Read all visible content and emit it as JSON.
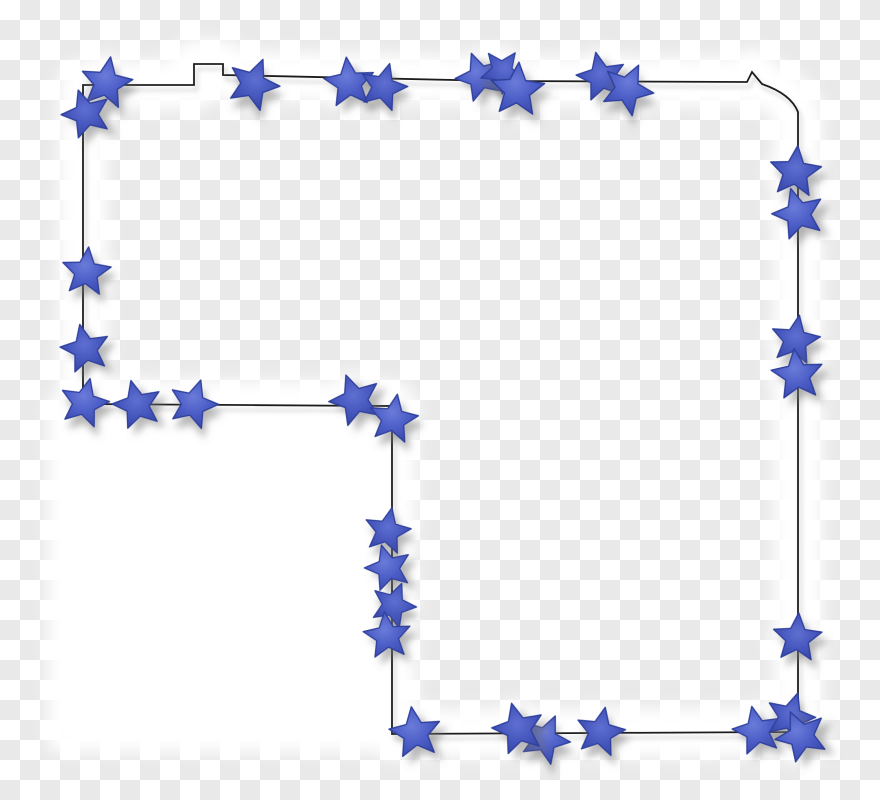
{
  "image": {
    "type": "clipart-star-border-frame",
    "description": "L-shaped black map-style outline decorated with blue cut-out stars on a transparency checkerboard, with soft white halo backing",
    "width": 880,
    "height": 800
  },
  "background": {
    "square_size": 20,
    "light": "#ffffff",
    "dark": "#e9e9e9"
  },
  "halo": {
    "color": "#ffffff",
    "outline_band_width": 48,
    "star_glow_radius": 28,
    "blur": 8,
    "bottom_left_rect": {
      "x": 48,
      "y": 396,
      "width": 344,
      "height": 356
    }
  },
  "outline": {
    "path_d": "M 83 85 L 194 85 L 194 64 L 223 64 L 223 75 L 500 81 L 747 82 L 752 72 L 762 84 Q 791 94 798 112 L 798 732 L 392 734 L 392 406 L 83 404 Z",
    "color": "#1f1f1f",
    "width": 1.8,
    "shadow": {
      "dx": 3,
      "dy": 5,
      "blur": 2.2,
      "color": "#8a8a8a",
      "opacity": 0.45
    }
  },
  "star_shape": {
    "path_d": "M 0 -26.5 L 7.6 -9.4 L 25.8 -8 L 12.2 4.2 L 16.4 21.8 L 0.4 12.2 L -15.4 21.4 L -11.6 3.8 L -25.2 -7.4 L -7.4 -9.6 Z"
  },
  "stars": {
    "fill_center": "#6b7bd9",
    "fill_mid": "#4c5ec7",
    "fill_edge": "#3b4aad",
    "fill_center_b": "#5f6fd0",
    "fill_mid_b": "#4556bd",
    "fill_edge_b": "#36459f",
    "stroke": "#2f3f9c",
    "shadow": {
      "dx": 6,
      "dy": 8,
      "blur": 4,
      "color": "#6f6f6f",
      "opacity": 0.5
    },
    "count": 33,
    "items": [
      {
        "cx": 106,
        "cy": 83,
        "rot": 10,
        "s": 1
      },
      {
        "cx": 86,
        "cy": 114,
        "rot": -18,
        "s": 0.95
      },
      {
        "cx": 86,
        "cy": 272,
        "rot": 6,
        "s": 0.95
      },
      {
        "cx": 85,
        "cy": 349,
        "rot": -12,
        "s": 0.95
      },
      {
        "cx": 84,
        "cy": 403,
        "rot": 14,
        "s": 0.95
      },
      {
        "cx": 253,
        "cy": 84,
        "rot": 22,
        "s": 1
      },
      {
        "cx": 349,
        "cy": 83,
        "rot": -6,
        "s": 0.98
      },
      {
        "cx": 383,
        "cy": 87,
        "rot": 16,
        "s": 0.92
      },
      {
        "cx": 480,
        "cy": 77,
        "rot": -20,
        "s": 0.95
      },
      {
        "cx": 502,
        "cy": 71,
        "rot": 36,
        "s": 0.85
      },
      {
        "cx": 517,
        "cy": 90,
        "rot": 4,
        "s": 1.05
      },
      {
        "cx": 601,
        "cy": 77,
        "rot": -12,
        "s": 0.95
      },
      {
        "cx": 627,
        "cy": 89,
        "rot": 26,
        "s": 1
      },
      {
        "cx": 795,
        "cy": 172,
        "rot": 6,
        "s": 1
      },
      {
        "cx": 798,
        "cy": 214,
        "rot": -16,
        "s": 1
      },
      {
        "cx": 795,
        "cy": 340,
        "rot": 10,
        "s": 0.95
      },
      {
        "cx": 797,
        "cy": 375,
        "rot": -6,
        "s": 1
      },
      {
        "cx": 797,
        "cy": 638,
        "rot": 4,
        "s": 0.95
      },
      {
        "cx": 757,
        "cy": 731,
        "rot": -12,
        "s": 0.95
      },
      {
        "cx": 790,
        "cy": 717,
        "rot": 18,
        "s": 0.95
      },
      {
        "cx": 801,
        "cy": 736,
        "rot": -24,
        "s": 1
      },
      {
        "cx": 600,
        "cy": 732,
        "rot": 12,
        "s": 0.95
      },
      {
        "cx": 545,
        "cy": 739,
        "rot": 24,
        "s": 0.95
      },
      {
        "cx": 518,
        "cy": 729,
        "rot": -14,
        "s": 1
      },
      {
        "cx": 415,
        "cy": 733,
        "rot": -8,
        "s": 1
      },
      {
        "cx": 387,
        "cy": 531,
        "rot": 12,
        "s": 0.9
      },
      {
        "cx": 388,
        "cy": 568,
        "rot": -16,
        "s": 0.9
      },
      {
        "cx": 393,
        "cy": 605,
        "rot": 22,
        "s": 0.88
      },
      {
        "cx": 387,
        "cy": 636,
        "rot": -6,
        "s": 0.92
      },
      {
        "cx": 137,
        "cy": 405,
        "rot": -14,
        "s": 0.95
      },
      {
        "cx": 193,
        "cy": 404,
        "rot": 18,
        "s": 0.95
      },
      {
        "cx": 355,
        "cy": 400,
        "rot": -20,
        "s": 1
      },
      {
        "cx": 393,
        "cy": 419,
        "rot": 10,
        "s": 0.95
      }
    ]
  }
}
